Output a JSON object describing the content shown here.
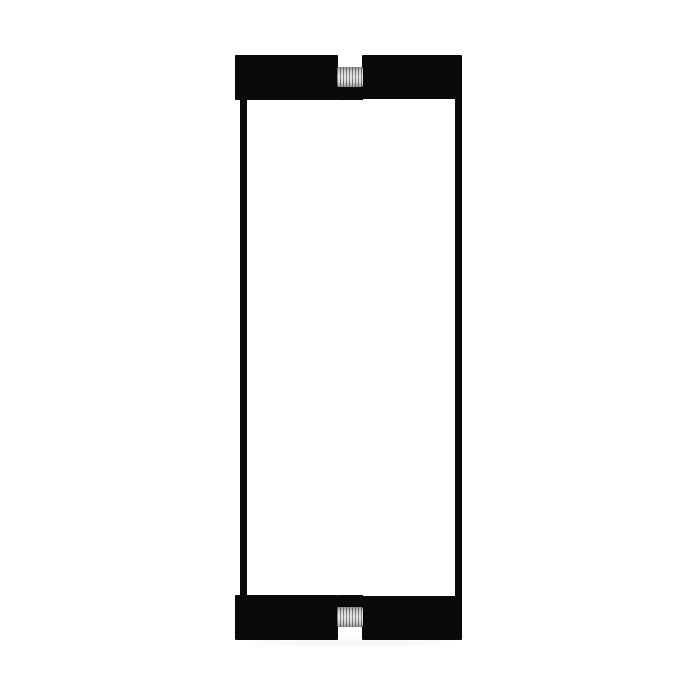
{
  "image": {
    "type": "product-photo",
    "description": "Black square-profile back-to-back door pull handle set with threaded fastener studs, on a plain white background",
    "visible_text": "",
    "colors": {
      "bg": "#ffffff",
      "handle": "#0a0a0a",
      "screw-light": "#d9d9d9",
      "screw-dark": "#6e6e6e"
    },
    "parts": {
      "pad_top_left": "mounting pad",
      "pad_top_right": "mounting pad",
      "pad_bottom_left": "mounting pad",
      "pad_bottom_right": "mounting pad",
      "bar_left": "vertical handle bar",
      "bar_right": "vertical handle bar",
      "screw_top": "threaded fastener stud",
      "screw_bottom": "threaded fastener stud"
    }
  }
}
